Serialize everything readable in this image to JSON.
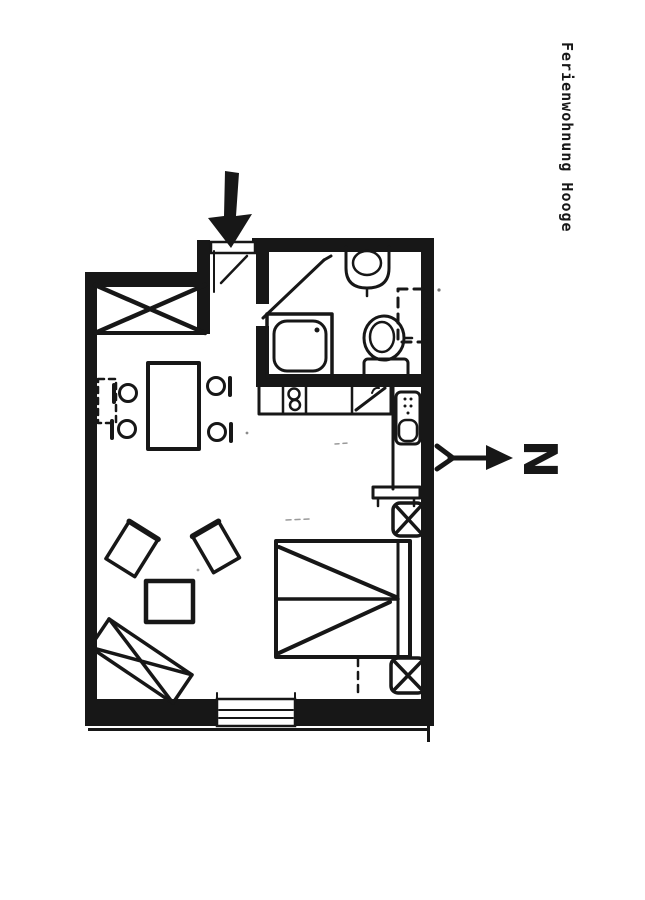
{
  "title_label": "Ferienwohnung Hooge",
  "compass": {
    "letter": "N",
    "points": "right"
  },
  "colors": {
    "paper": "#ffffff",
    "ink": "#171717"
  },
  "floor_plan": {
    "style": "hand-drawn scanned sketch",
    "entrance_marker": "large black arrow pointing down at door",
    "rooms": [
      "entrance-hall",
      "bathroom",
      "kitchenette",
      "living-sleeping-room"
    ],
    "fixtures": [
      "shower",
      "washbasin",
      "toilet",
      "stove-2-burners",
      "kitchen-sink",
      "boiler"
    ],
    "furniture": [
      "wardrobe-x-symbol",
      "dining-table",
      "chair",
      "chair",
      "chair",
      "chair",
      "radiator-dashed",
      "armchair",
      "armchair",
      "coffee-table",
      "bench-x-symbol",
      "double-bed",
      "bedside-stool-x",
      "bedside-stool-x",
      "wall-shelf"
    ],
    "window_count": 1
  }
}
